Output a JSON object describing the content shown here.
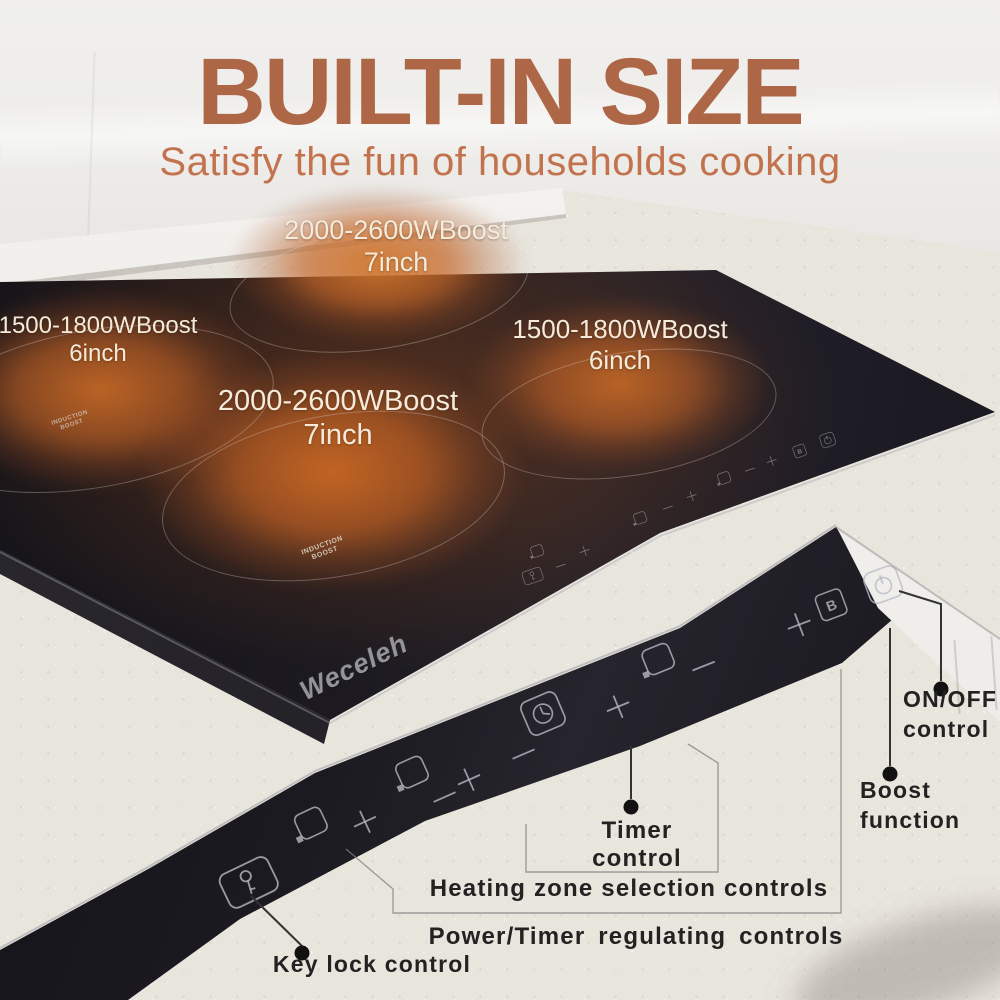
{
  "header": {
    "title": "BUILT-IN SIZE",
    "subtitle": "Satisfy the fun of households cooking"
  },
  "cooktop": {
    "brand": "Weceleh",
    "surface_mark_line1": "INDUCTION",
    "surface_mark_line2": "BOOST",
    "burners": [
      {
        "position": "top",
        "power": "2000-2600WBoost",
        "size": "7inch"
      },
      {
        "position": "left",
        "power": "1500-1800WBoost",
        "size": "6inch"
      },
      {
        "position": "right",
        "power": "1500-1800WBoost",
        "size": "6inch"
      },
      {
        "position": "center",
        "power": "2000-2600WBoost",
        "size": "7inch"
      }
    ]
  },
  "control_strip": {
    "boost_letter": "B",
    "icons": [
      "key-lock",
      "heating-zone",
      "plus",
      "heating-zone",
      "minus",
      "plus",
      "minus",
      "timer",
      "plus",
      "heating-zone",
      "minus",
      "plus",
      "boost",
      "power"
    ]
  },
  "annotations": {
    "on_off": "ON/OFF control",
    "boost": "Boost function",
    "timer": "Timer control",
    "heating_zone": "Heating zone selection controls",
    "power_timer": "Power/Timer  regulating  controls",
    "key_lock": "Key lock control"
  },
  "colors": {
    "title": "#ae6746",
    "subtitle": "#c3724e",
    "glow": "#c86a26",
    "glass": "#17161c"
  }
}
